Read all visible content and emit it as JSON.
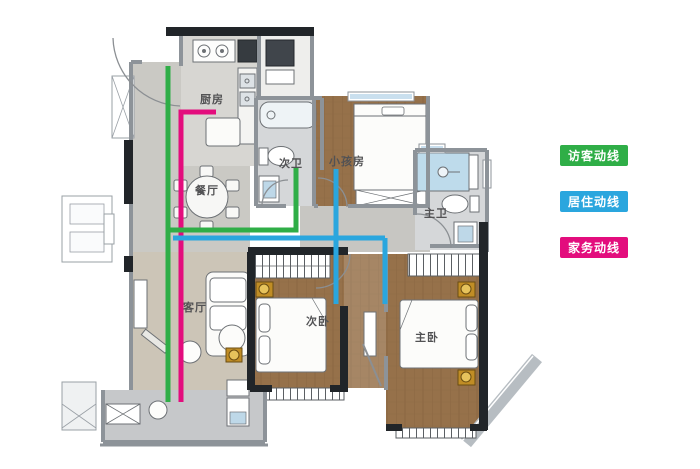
{
  "legend": {
    "text_color": "#ffffff",
    "items": [
      {
        "id": "visitor",
        "label": "访客动线",
        "color": "#2fae47"
      },
      {
        "id": "living",
        "label": "居住动线",
        "color": "#2aa6de"
      },
      {
        "id": "housework",
        "label": "家务动线",
        "color": "#e30d7d"
      }
    ]
  },
  "floorplan": {
    "rooms": [
      {
        "id": "kitchen",
        "label": "厨房",
        "x": 212,
        "y": 103
      },
      {
        "id": "dining-room",
        "label": "餐厅",
        "x": 207,
        "y": 194
      },
      {
        "id": "guest-bathroom",
        "label": "次卫",
        "x": 291,
        "y": 167
      },
      {
        "id": "kids-room",
        "label": "小孩房",
        "x": 347,
        "y": 165
      },
      {
        "id": "master-bathroom",
        "label": "主卫",
        "x": 436,
        "y": 217
      },
      {
        "id": "living-room",
        "label": "客厅",
        "x": 195,
        "y": 311
      },
      {
        "id": "second-bedroom",
        "label": "次卧",
        "x": 318,
        "y": 325
      },
      {
        "id": "master-bedroom",
        "label": "主卧",
        "x": 427,
        "y": 341
      }
    ],
    "routes": [
      {
        "id": "housework-route",
        "legend_label": "家务动线",
        "color": "#e30d7d",
        "segments": [
          [
            [
              216,
              112
            ],
            [
              181,
              112
            ],
            [
              181,
              402
            ]
          ]
        ]
      },
      {
        "id": "visitor-route",
        "legend_label": "访客动线",
        "color": "#2fae47",
        "segments": [
          [
            [
              168,
              66
            ],
            [
              168,
              402
            ]
          ],
          [
            [
              168,
              230
            ],
            [
              296,
              230
            ],
            [
              296,
              167
            ]
          ]
        ]
      },
      {
        "id": "living-route",
        "legend_label": "居住动线",
        "color": "#2aa6de",
        "segments": [
          [
            [
              173,
              238
            ],
            [
              385,
              238
            ]
          ],
          [
            [
              336,
              169
            ],
            [
              336,
              304
            ]
          ],
          [
            [
              385,
              238
            ],
            [
              385,
              304
            ]
          ]
        ]
      }
    ]
  }
}
